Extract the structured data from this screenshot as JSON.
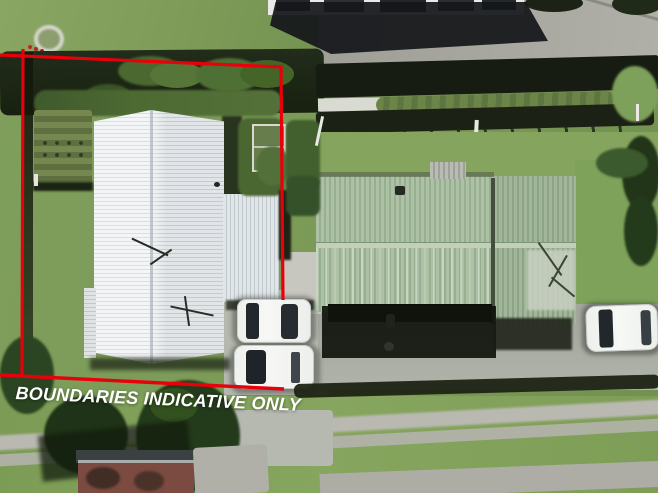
{
  "overlay": {
    "caption": "BOUNDARIES INDICATIVE ONLY",
    "caption_color": "#ffffff",
    "boundary_color": "#e8000a"
  },
  "scene": {
    "type": "aerial-drone-photo",
    "description": "Top-down drone photograph of a residential section outlined in red: white corrugated-iron roof house with vegetable garden and two parked white cars, neighbouring pale-green corrugated roof building with a third white car, dark boundary hedges, concrete driveways, street verge with footpaths and a dark-red roofed building across the street",
    "palette": {
      "grass": "#7e9c5b",
      "hedge_shadow": "#1a2113",
      "white_roof": "#e9edf0",
      "green_roof": "#a4b99c",
      "concrete": "#b0b0a8",
      "car_white": "#f2f4f1",
      "street_building_wall": "#7b4a41"
    }
  }
}
